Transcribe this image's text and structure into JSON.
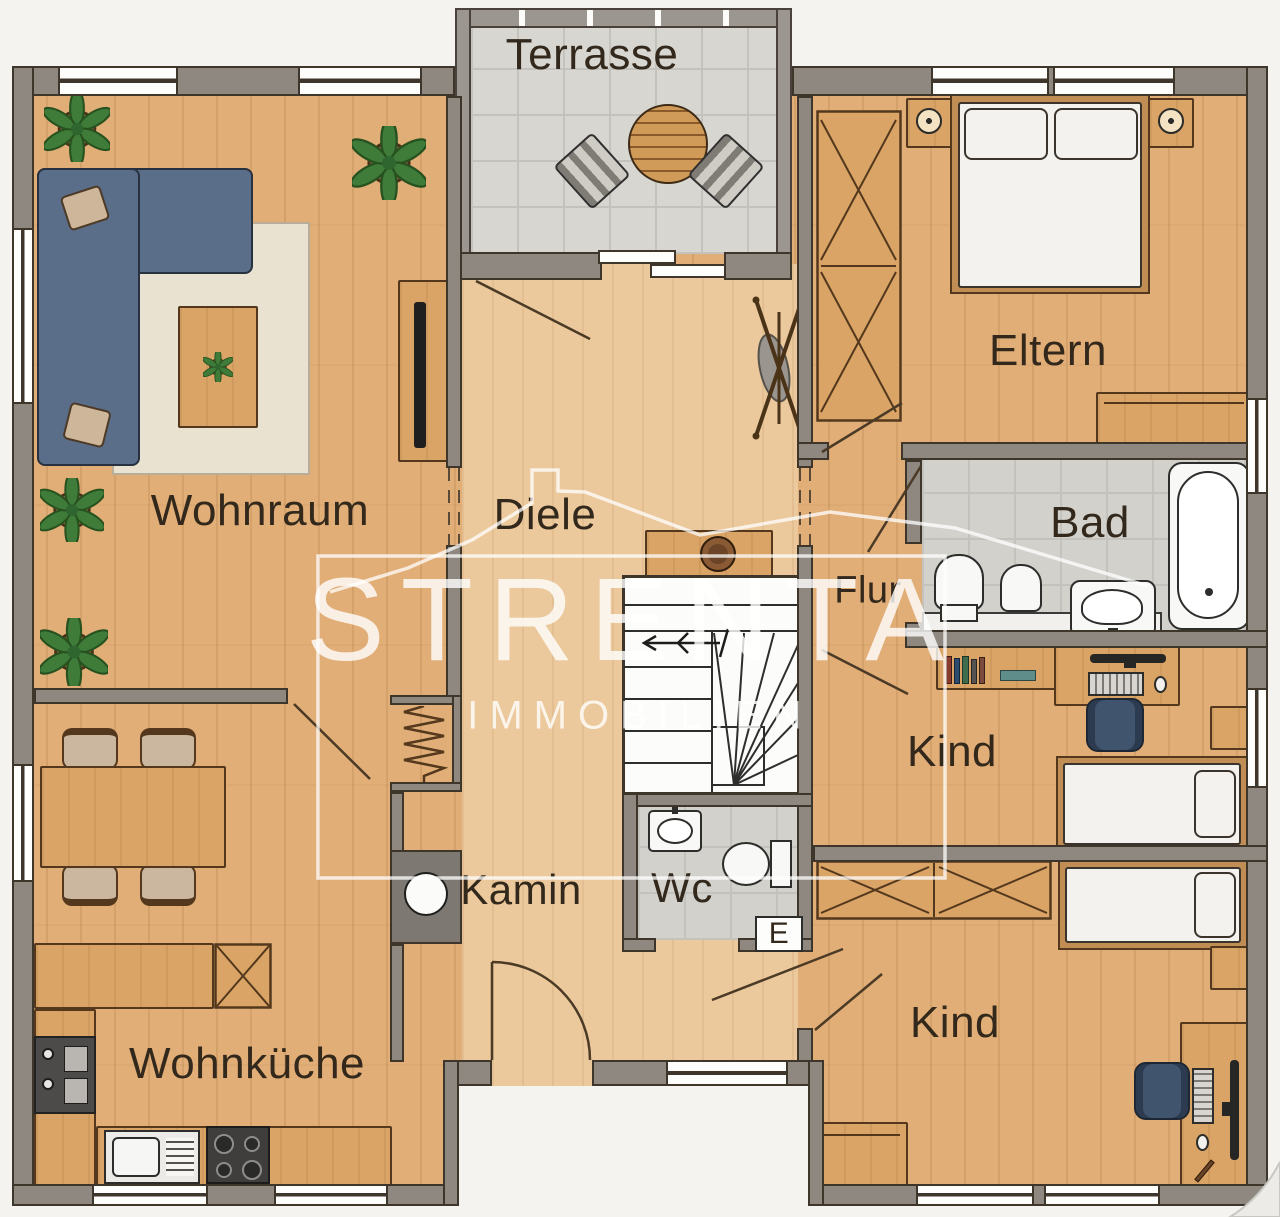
{
  "watermark": {
    "brand": "STRENTA",
    "tagline": "IMMOBILIEN"
  },
  "rooms": {
    "terrasse": "Terrasse",
    "wohnraum": "Wohnraum",
    "diele": "Diele",
    "eltern": "Eltern",
    "bad": "Bad",
    "flur": "Flur",
    "kind_oben": "Kind",
    "kamin": "Kamin",
    "wc": "Wc",
    "kind_unten": "Kind",
    "wohnkueche": "Wohnküche"
  },
  "markers": {
    "eingang": "E"
  },
  "colors": {
    "wall": "#8e8880",
    "wood_floor": "#e2ae77",
    "hall_floor": "#ecc99c",
    "tile_floor": "#d8d6d1",
    "sofa_blue": "#5b6e89",
    "furniture_wood": "#d9a465",
    "label_text": "#32281c",
    "watermark_white": "rgba(255,255,255,0.8)"
  }
}
